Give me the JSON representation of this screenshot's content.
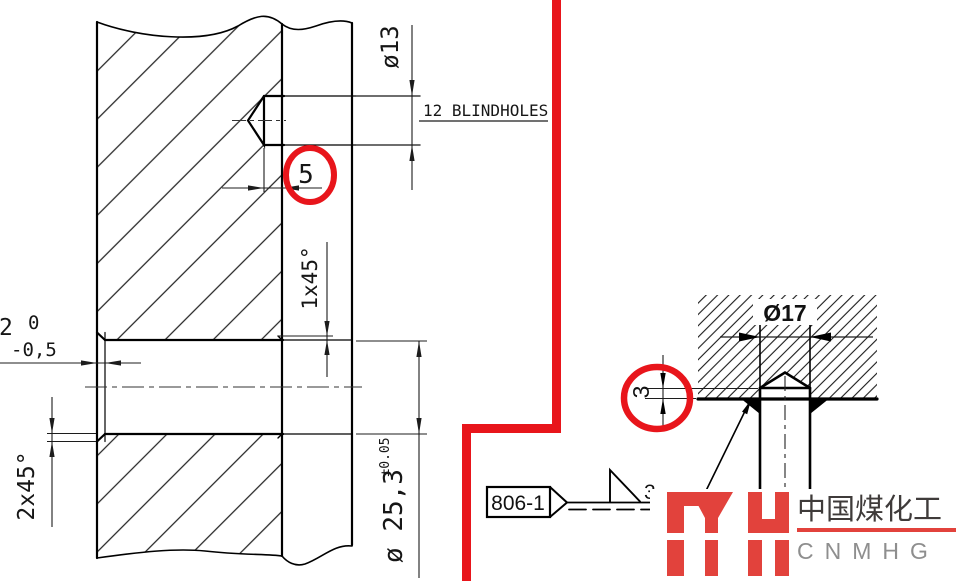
{
  "colors": {
    "annotation_red": "#e8151b",
    "logo_red": "#e2423c",
    "ink": "#1b1b1b"
  },
  "main_view": {
    "hole_diameter": "ø13",
    "holes_note": "12 BLINDHOLES",
    "hole_depth": "5",
    "right_chamfer": "1x45°",
    "counterbore_depth": "2",
    "counterbore_tol_upper": "0",
    "counterbore_tol_lower": "-0,5",
    "left_chamfer": "2x45°",
    "bore_diameter": "ø 25,3",
    "bore_tolerance": "±0.05"
  },
  "detail_view": {
    "hole_diameter": "Ø17",
    "protrusion_height": "3",
    "weld_size": "3",
    "weld_process_tag": "806-1"
  },
  "watermark": {
    "company_cn": "中国煤化工",
    "company_en": "CNMHG"
  }
}
